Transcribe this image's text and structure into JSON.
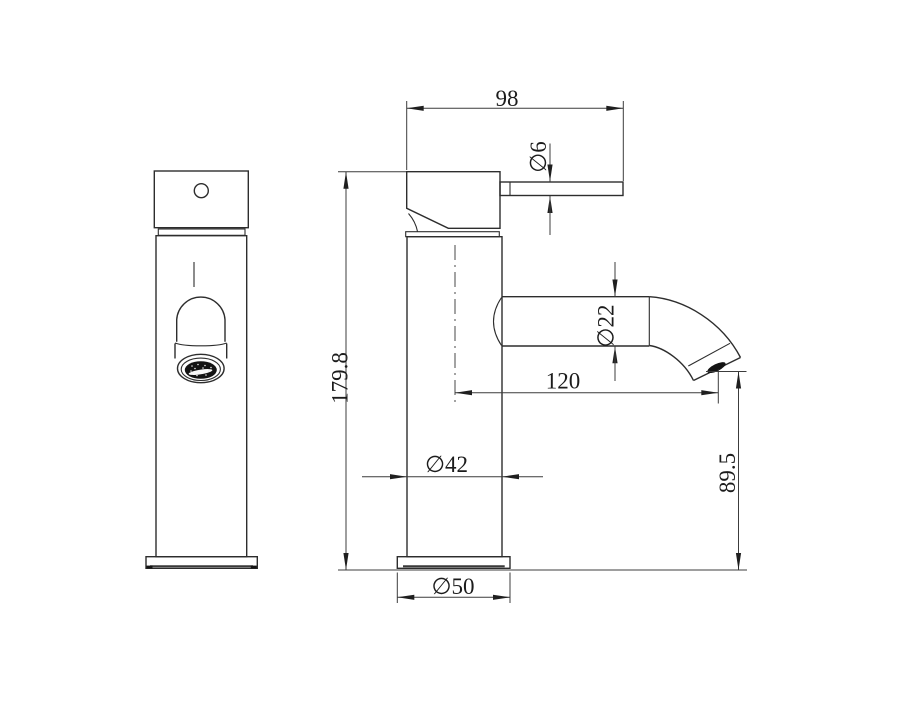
{
  "drawing": {
    "type": "technical-dimension-drawing",
    "subject": "single-lever basin faucet, front and side views",
    "background_color": "#ffffff",
    "object_line_color": "#2d2d2d",
    "dimension_line_color": "#3c3c3c",
    "text_color": "#1c1c1c"
  },
  "dimensions": {
    "lever_reach": {
      "label": "98",
      "orientation": "horizontal"
    },
    "lever_diameter": {
      "label": "∅6",
      "orientation": "vertical-rotated"
    },
    "overall_height": {
      "label": "179.8",
      "orientation": "vertical-rotated"
    },
    "spout_diameter": {
      "label": "∅22",
      "orientation": "vertical-rotated"
    },
    "spout_reach": {
      "label": "120",
      "orientation": "horizontal"
    },
    "outlet_height": {
      "label": "89.5",
      "orientation": "vertical-rotated"
    },
    "body_diameter": {
      "label": "∅42",
      "orientation": "horizontal"
    },
    "base_diameter": {
      "label": "∅50",
      "orientation": "horizontal"
    }
  }
}
